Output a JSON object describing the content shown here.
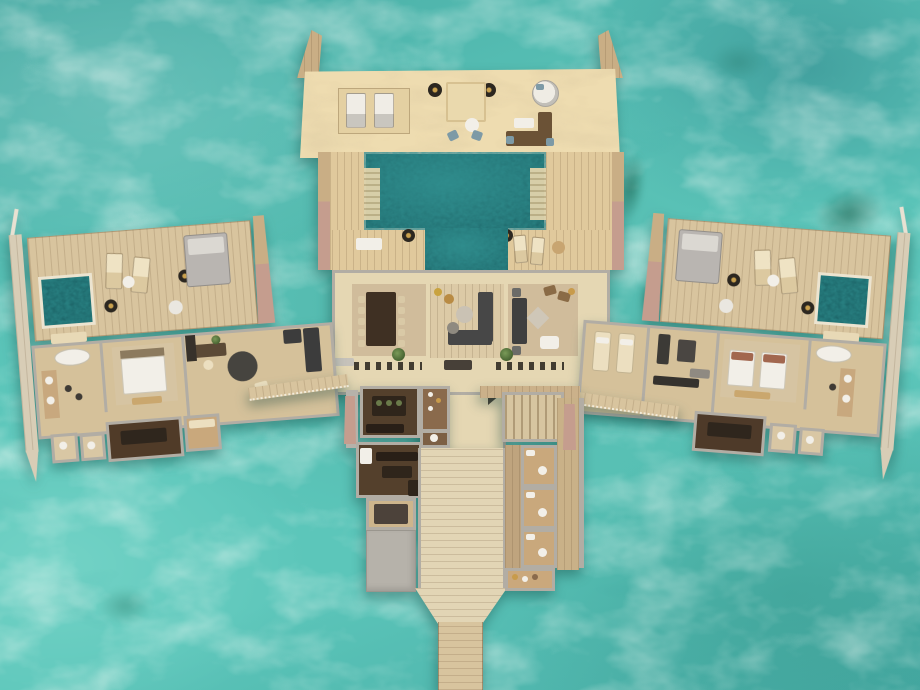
{
  "scene": {
    "kind": "overwater-villa-floorplan-render",
    "view": "top-down aerial 3D render",
    "visible_text": "none"
  },
  "palette": {
    "water_base": "#5cc6ba",
    "water_deep": "#47aba4",
    "pool_water": "#2f8a8a",
    "pool_deep": "#1e686b",
    "pool_rim": "#ece4d0",
    "sand": "#eedcb0",
    "sand_dark": "#e0c99c",
    "wood": "#c9ae85",
    "wood_light": "#d8c49e",
    "wood_pale": "#e2d5b5",
    "wall": "#b2ada4",
    "wall_light": "#d8d4cc",
    "floor": "#e5d7b3",
    "floor_wood": "#d5c19a",
    "rug": "#d0bc9b",
    "dark": "#3c3a36",
    "charcoal": "#2b2925",
    "brown_sofa": "#6b5236",
    "cream": "#ecdfc0",
    "white": "#f2efe8",
    "gray_furn": "#b7b3af",
    "kitchen_floor": "#54402c",
    "kitchen_dark": "#2f251b",
    "pantry_wood": "#8a6a4c",
    "stairs": "#d7c5a0",
    "slab": "#b6b2aa",
    "pink": "#c59d8e",
    "green": "#5d7a45",
    "blue_chair": "#7d9aa6",
    "rust": "#a2674f"
  },
  "regions": {
    "center": [
      "sun-deck",
      "main-pool",
      "pool-steps",
      "living-room",
      "dining-area",
      "lounge-area",
      "entry-hall"
    ],
    "left_wing": [
      "plunge-pool",
      "outdoor-deck",
      "bathroom",
      "bedroom",
      "study",
      "dressing-room"
    ],
    "right_wing": [
      "plunge-pool",
      "outdoor-deck",
      "spa-room",
      "gym",
      "twin-bedroom",
      "bathroom"
    ],
    "service": [
      "kitchen",
      "pantry",
      "staff-rooms",
      "staircase",
      "guest-toilets",
      "flat-roof"
    ],
    "access": [
      "jetty",
      "left-walkway",
      "right-walkway",
      "side-piers"
    ]
  }
}
